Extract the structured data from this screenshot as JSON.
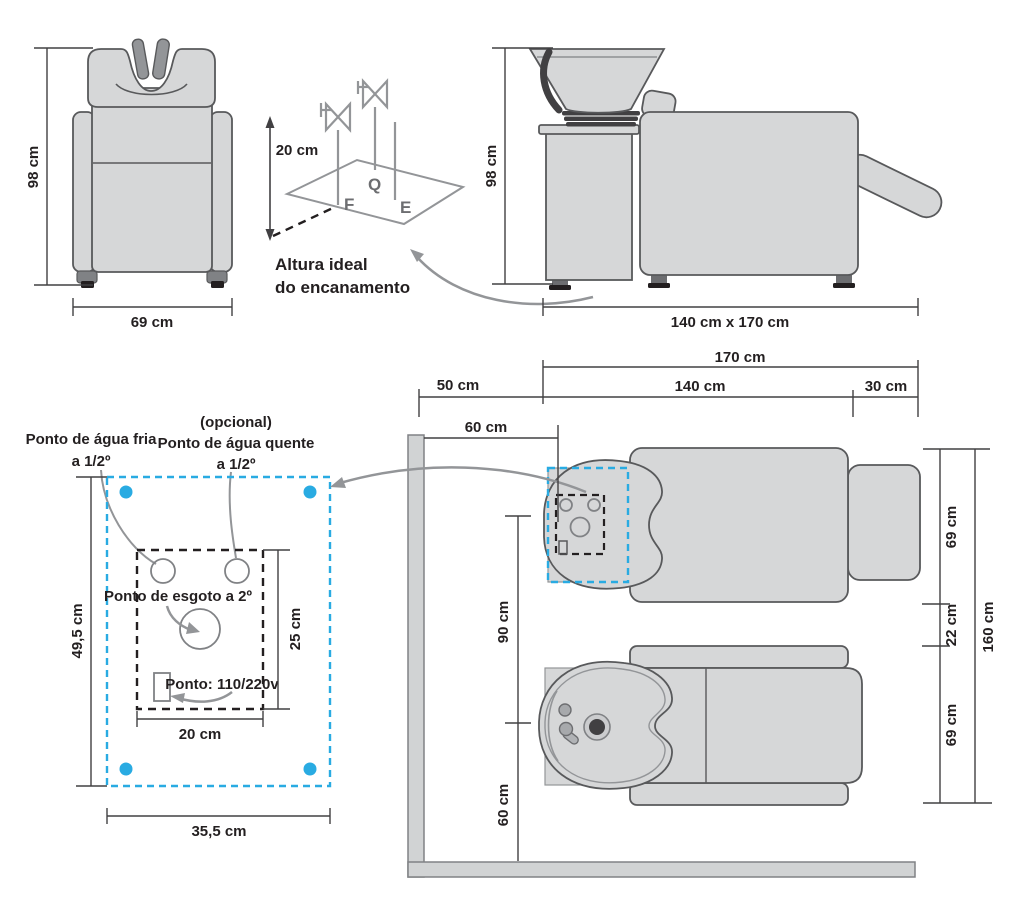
{
  "title": "Diagrama de instalação de lavatório de cabeleireiro",
  "colors": {
    "fill_gray": "#d6d7d8",
    "outline_gray": "#58595b",
    "mid_gray": "#939598",
    "dark_gray": "#414042",
    "text": "#231f20",
    "accent_blue": "#29abe2",
    "wall_gray": "#d1d3d4"
  },
  "front_view": {
    "height": "98 cm",
    "width": "69 cm"
  },
  "pipe_height_diagram": {
    "height": "20 cm",
    "point_f": "F",
    "point_q": "Q",
    "point_e": "E",
    "caption_line1": "Altura ideal",
    "caption_line2": "do encanamento"
  },
  "side_view": {
    "height": "98 cm",
    "footprint": "140 cm x 170 cm"
  },
  "wall_points_detail": {
    "cold_water_line1": "Ponto de água fria",
    "cold_water_line2": "a 1/2º",
    "hot_water_optional": "(opcional)",
    "hot_water_line1": "Ponto de água quente",
    "hot_water_line2": "a 1/2º",
    "drain_label": "Ponto de esgoto a 2º",
    "power_label": "Ponto: 110/220v",
    "outer_height": "49,5 cm",
    "inner_height": "25 cm",
    "inner_width": "20 cm",
    "outer_width": "35,5 cm"
  },
  "floor_plan": {
    "wall_offset": "50 cm",
    "total_length": "170 cm",
    "chair_length": "140 cm",
    "legrest_length": "30 cm",
    "unit_offset": "60 cm",
    "basin_spacing": "90 cm",
    "wall_clearance": "60 cm",
    "chair1_width": "69 cm",
    "gap": "22 cm",
    "chair2_width": "69 cm",
    "total_width": "160 cm"
  }
}
